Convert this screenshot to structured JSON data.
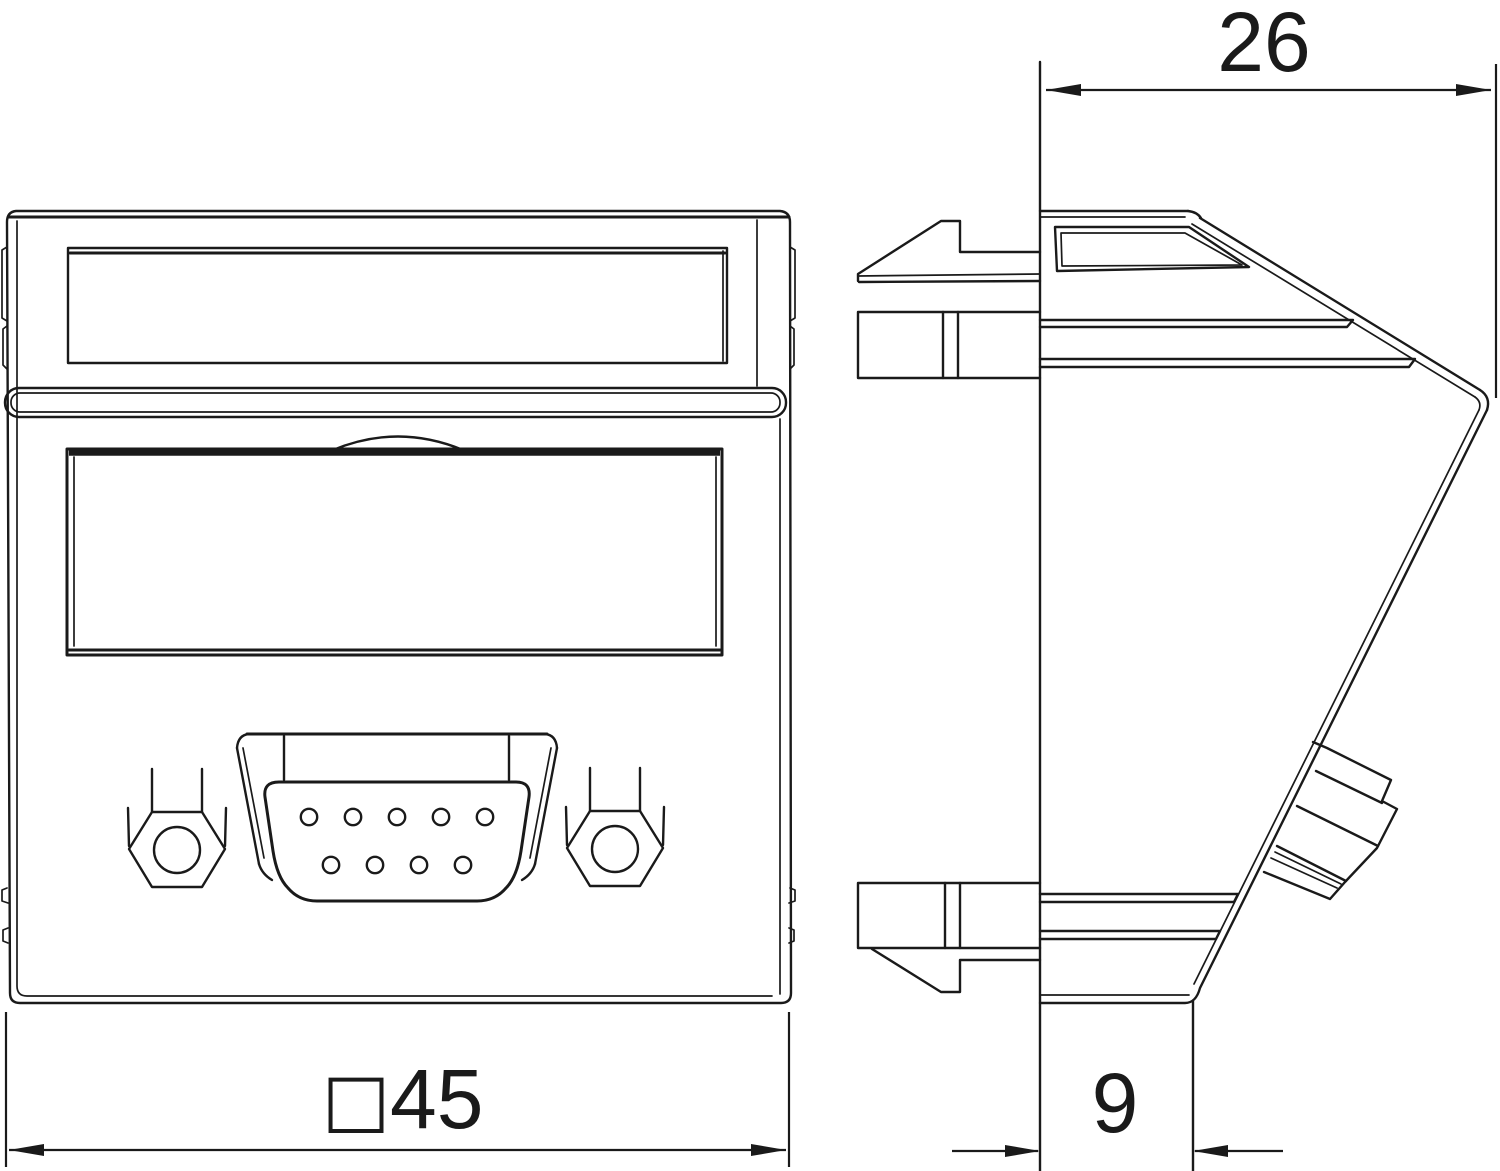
{
  "document": {
    "kind": "technical-drawing",
    "background_color": "#ffffff",
    "line_color": "#1a1a1a",
    "views": [
      {
        "id": "front",
        "label": "front view"
      },
      {
        "id": "side",
        "label": "side view"
      }
    ]
  },
  "dimensions": {
    "top_width": {
      "label": "26"
    },
    "front_size": {
      "prefix": "□",
      "label": "45"
    },
    "bottom_depth": {
      "label": "9"
    }
  },
  "front_view": {
    "dsub_holes_top_row": 5,
    "dsub_holes_bottom_row": 4,
    "hex_jackscrews": 2
  }
}
